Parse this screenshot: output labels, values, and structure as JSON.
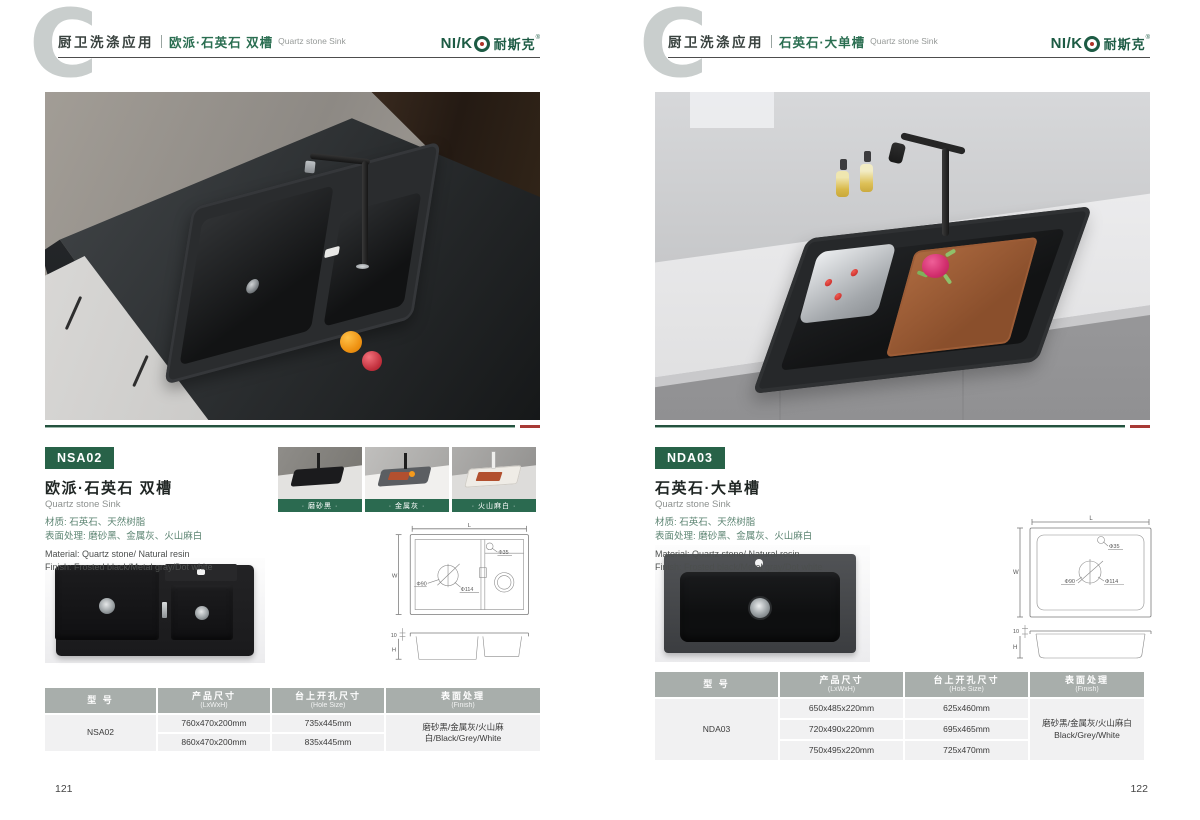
{
  "shared": {
    "category_label": "厨卫洗涤应用",
    "brand": {
      "logo_latin": "NI/K",
      "logo_cn": "耐斯克",
      "reg": "®"
    },
    "drawing_labels": {
      "L": "L",
      "W": "W",
      "H": "H",
      "d35": "Φ35",
      "d90": "Φ90",
      "d114": "Φ114",
      "rim": "10"
    }
  },
  "colors": {
    "brand_green": "#286248",
    "accent_red": "#a83a35",
    "table_header_gray": "#a8aeab"
  },
  "page_left": {
    "page_number": "121",
    "header": {
      "title_cn": "欧派·石英石 双槽",
      "title_en": "Quartz stone Sink"
    },
    "product": {
      "model_badge": "NSA02",
      "name_cn": "欧派·石英石 双槽",
      "name_en": "Quartz stone Sink",
      "material_cn": "材质: 石英石、天然树脂",
      "surface_cn": "表面处理: 磨砂黑、金属灰、火山麻白",
      "material_en": "Material: Quartz stone/ Natural resin",
      "finish_en": "Finish: Frosted black/Metal gray/Dot white"
    },
    "swatches": [
      {
        "label": "· 磨砂黑 ·"
      },
      {
        "label": "· 金属灰 ·"
      },
      {
        "label": "· 火山麻白 ·"
      }
    ],
    "table": {
      "headers": [
        {
          "cn": "型 号",
          "en": ""
        },
        {
          "cn": "产品尺寸",
          "en": "(LxWxH)"
        },
        {
          "cn": "台上开孔尺寸",
          "en": "(Hole Size)"
        },
        {
          "cn": "表面处理",
          "en": "(Finish)"
        }
      ],
      "model": "NSA02",
      "rows": [
        {
          "size": "760x470x200mm",
          "hole": "735x445mm"
        },
        {
          "size": "860x470x200mm",
          "hole": "835x445mm"
        }
      ],
      "finish": "磨砂黑/金属灰/火山麻白/Black/Grey/White"
    }
  },
  "page_right": {
    "page_number": "122",
    "header": {
      "title_cn": "石英石·大单槽",
      "title_en": "Quartz stone Sink"
    },
    "product": {
      "model_badge": "NDA03",
      "name_cn": "石英石·大单槽",
      "name_en": "Quartz stone Sink",
      "material_cn": "材质: 石英石、天然树脂",
      "surface_cn": "表面处理: 磨砂黑、金属灰、火山麻白",
      "material_en": "Material: Quartz stone/ Natural resin",
      "finish_en": "Finish: Frosted black/Metal gray/Dot white"
    },
    "table": {
      "headers": [
        {
          "cn": "型 号",
          "en": ""
        },
        {
          "cn": "产品尺寸",
          "en": "(LxWxH)"
        },
        {
          "cn": "台上开孔尺寸",
          "en": "(Hole Size)"
        },
        {
          "cn": "表面处理",
          "en": "(Finish)"
        }
      ],
      "model": "NDA03",
      "rows": [
        {
          "size": "650x485x220mm",
          "hole": "625x460mm"
        },
        {
          "size": "720x490x220mm",
          "hole": "695x465mm"
        },
        {
          "size": "750x495x220mm",
          "hole": "725x470mm"
        }
      ],
      "finish_cn": "磨砂黑/金属灰/火山麻白",
      "finish_en": "Black/Grey/White"
    }
  }
}
